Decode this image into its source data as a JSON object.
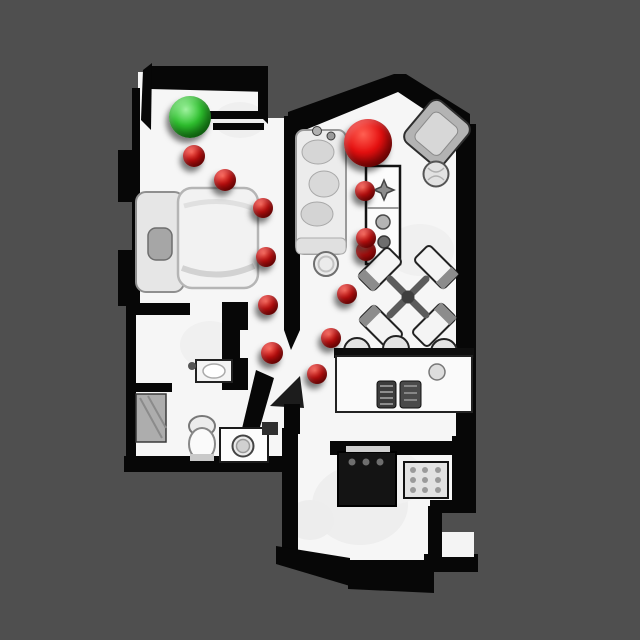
{
  "scene": {
    "kind": "top-down-3d-scan-floorplan",
    "background_color": "#4f4f4f",
    "floor_color": "#f6f6f6",
    "wall_color": "#070707"
  },
  "markers": {
    "start": {
      "shape": "sphere",
      "x": 190,
      "y": 117,
      "r": 21,
      "colors": {
        "light": "#a0f2a0",
        "base": "#2fc32f",
        "dark": "#0b7a0b"
      }
    },
    "goal": {
      "shape": "sphere",
      "x": 368,
      "y": 143,
      "r": 24,
      "colors": {
        "light": "#ff6052",
        "base": "#e61010",
        "dark": "#7c0000"
      }
    },
    "waypoints": {
      "colors": {
        "light": "#ff6052",
        "base": "#df1010",
        "dark": "#7c0000"
      },
      "points": [
        {
          "x": 194,
          "y": 156,
          "r": 11
        },
        {
          "x": 225,
          "y": 180,
          "r": 11
        },
        {
          "x": 263,
          "y": 208,
          "r": 10
        },
        {
          "x": 266,
          "y": 257,
          "r": 10
        },
        {
          "x": 268,
          "y": 305,
          "r": 10
        },
        {
          "x": 272,
          "y": 353,
          "r": 11
        },
        {
          "x": 317,
          "y": 374,
          "r": 10
        },
        {
          "x": 331,
          "y": 338,
          "r": 10
        },
        {
          "x": 347,
          "y": 294,
          "r": 10
        },
        {
          "x": 366,
          "y": 251,
          "r": 10
        },
        {
          "x": 366,
          "y": 238,
          "r": 10
        },
        {
          "x": 365,
          "y": 191,
          "r": 10
        }
      ]
    }
  }
}
